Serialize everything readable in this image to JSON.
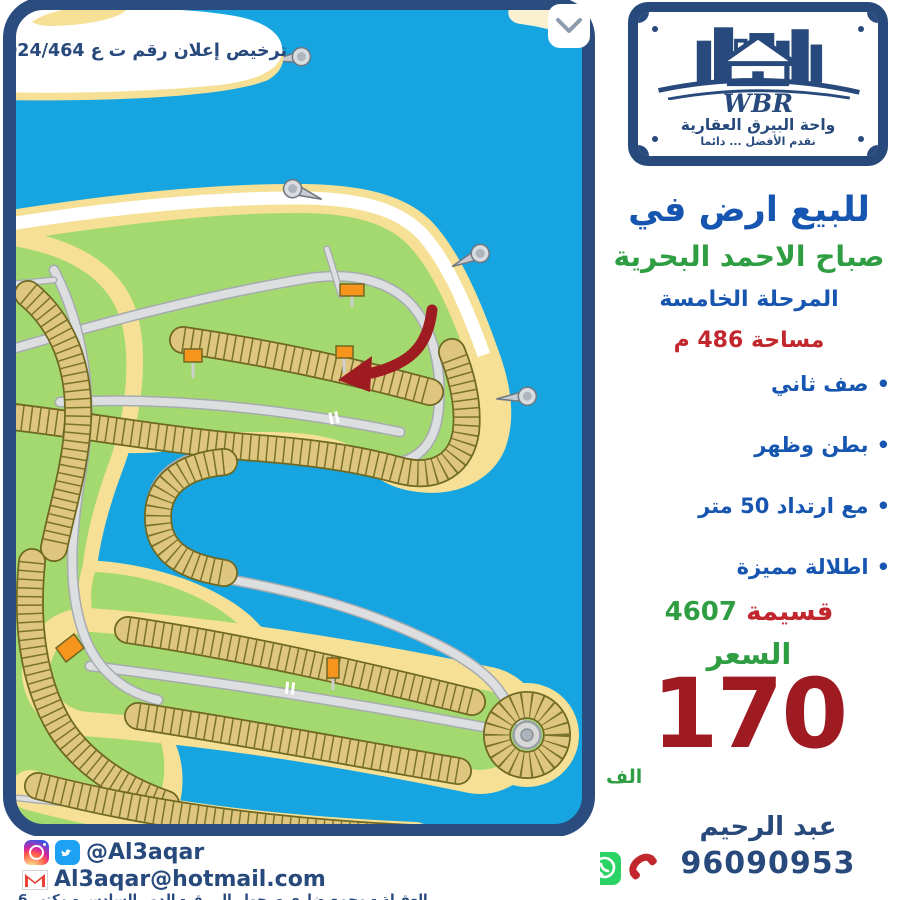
{
  "map": {
    "license_text": "ترخيص إعلان رقم ت ع 2024/464",
    "colors": {
      "water": "#16A5E0",
      "sand": "#F6E096",
      "green": "#A4D96F",
      "plot": "#DFC67F",
      "plot_border": "#6E6822",
      "road": "#DCDEDF",
      "frame_navy": "#2B4C7E",
      "arrow_red": "#9E1B21",
      "marker_orange": "#F7941D"
    }
  },
  "logo": {
    "wbr": "WBR",
    "name_ar": "واحة البيرق العقارية",
    "slogan_ar": "نقدم الأفضل ... دائما"
  },
  "listing": {
    "title": "للبيع ارض في",
    "location": "صباح الاحمد البحرية",
    "phase": "المرحلة الخامسة",
    "area": "مساحة 486 م",
    "features": [
      "صف ثاني",
      "بطن وظهر",
      "مع ارتداد 50 متر",
      "اطلالة مميزة"
    ],
    "plot_label": "قسيمة",
    "plot_number": "4607",
    "price_label": "السعر",
    "price_value": "170",
    "price_unit": "الف"
  },
  "contact": {
    "agent": "عبد الرحيم",
    "phone": "96090953",
    "social_handle": "@Al3aqar",
    "email": "Al3aqar@hotmail.com",
    "address": "العقيلة - مجمع ضاري - بجوار البيرق - الدور السادس - مكتب 6"
  },
  "text_colors": {
    "title_blue": "#1756B0",
    "location_green": "#2F9E43",
    "area_red": "#C1272D",
    "price_darkred": "#9E1B21",
    "contact_navy": "#27497B"
  }
}
